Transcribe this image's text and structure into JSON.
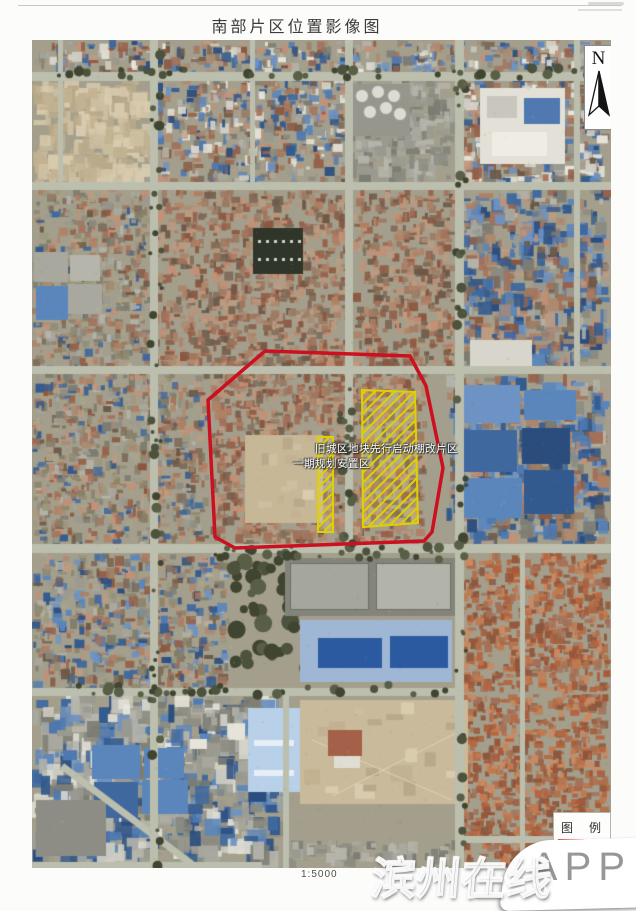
{
  "page": {
    "title": "南部片区位置影像图",
    "scale_label": "1:5000"
  },
  "north_arrow": {
    "label": "N"
  },
  "map": {
    "boundary_label_line1": "旧城区地块先行启动棚改片区",
    "boundary_label_line2": "一期规划安置区",
    "boundary_color": "#cc1020",
    "hatch_color": "#e2cf00"
  },
  "legend": {
    "title": "图　例"
  },
  "watermark": {
    "site_name": "滨州在线",
    "app_label": "APP"
  }
}
